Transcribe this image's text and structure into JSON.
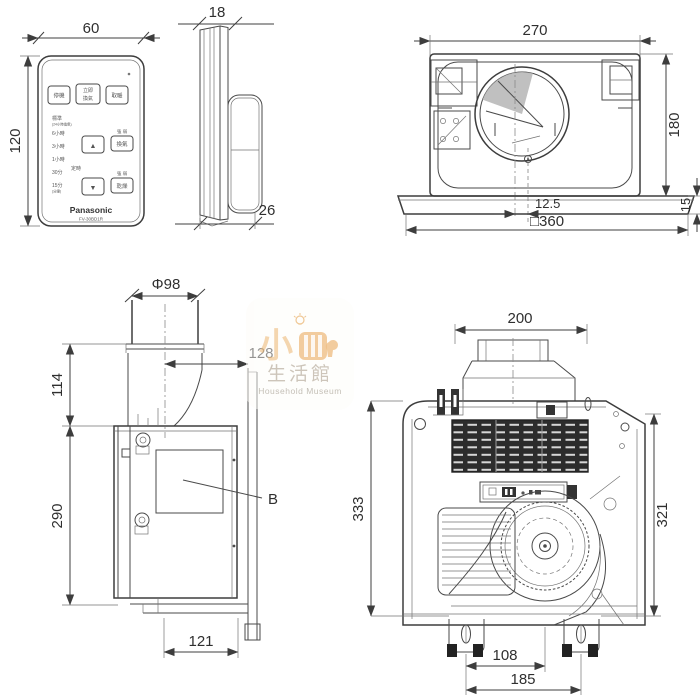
{
  "watermark": {
    "cn_prefix": "小",
    "cn_main": "生活館",
    "en": "Household Museum",
    "accent": "#eeb97a"
  },
  "remote_front": {
    "dim_width": "60",
    "dim_height": "120",
    "brand": "Panasonic",
    "model": "FV-30BD1R",
    "top_buttons": [
      {
        "label": "停機"
      },
      {
        "label_line1": "立即",
        "label_line2": "換氣"
      },
      {
        "label": "取暖"
      }
    ],
    "timer_scale": [
      {
        "label": "標準",
        "sub": "(24小時換氣)"
      },
      {
        "label": "6小時"
      },
      {
        "label": "3小時"
      },
      {
        "label": "1小時"
      },
      {
        "label": "30分"
      },
      {
        "label": "15分",
        "sub": "(分鐘)"
      }
    ],
    "timer_label": "定時",
    "up_symbol": "▲",
    "down_symbol": "▼",
    "right_buttons": [
      {
        "small": "強 弱",
        "label": "換氣"
      },
      {
        "small": "強 弱",
        "label": "乾燥"
      }
    ]
  },
  "remote_side": {
    "dim_thickness": "18",
    "dim_depth": "26"
  },
  "unit_top": {
    "dim_width": "270",
    "dim_height": "180",
    "dim_offset": "12.5",
    "dim_flange": "15",
    "dim_square": "□360"
  },
  "unit_side": {
    "dim_duct": "Φ98",
    "dim_duct_height": "114",
    "dim_body_height": "290",
    "dim_duct_offset": "128",
    "dim_bottom": "121",
    "callout": "B"
  },
  "unit_bottom": {
    "dim_duct_width": "200",
    "dim_left_height": "333",
    "dim_right_height": "321",
    "dim_bolt_offset": "108",
    "dim_bolt_span": "185"
  }
}
